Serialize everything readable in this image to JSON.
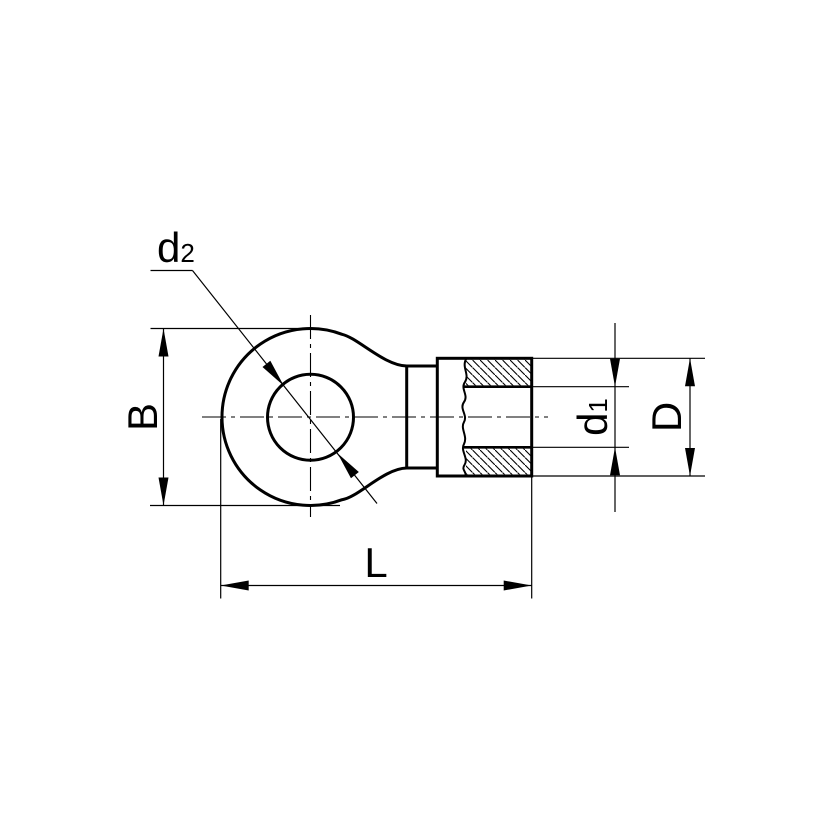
{
  "labels": {
    "hole_diameter": {
      "base": "d",
      "sub": "2"
    },
    "ring_width": "B",
    "bore_diameter": {
      "base": "d",
      "sub": "1"
    },
    "barrel_outer_diameter": "D",
    "overall_length": "L"
  },
  "colors": {
    "line": "#000000",
    "background": "#ffffff"
  }
}
